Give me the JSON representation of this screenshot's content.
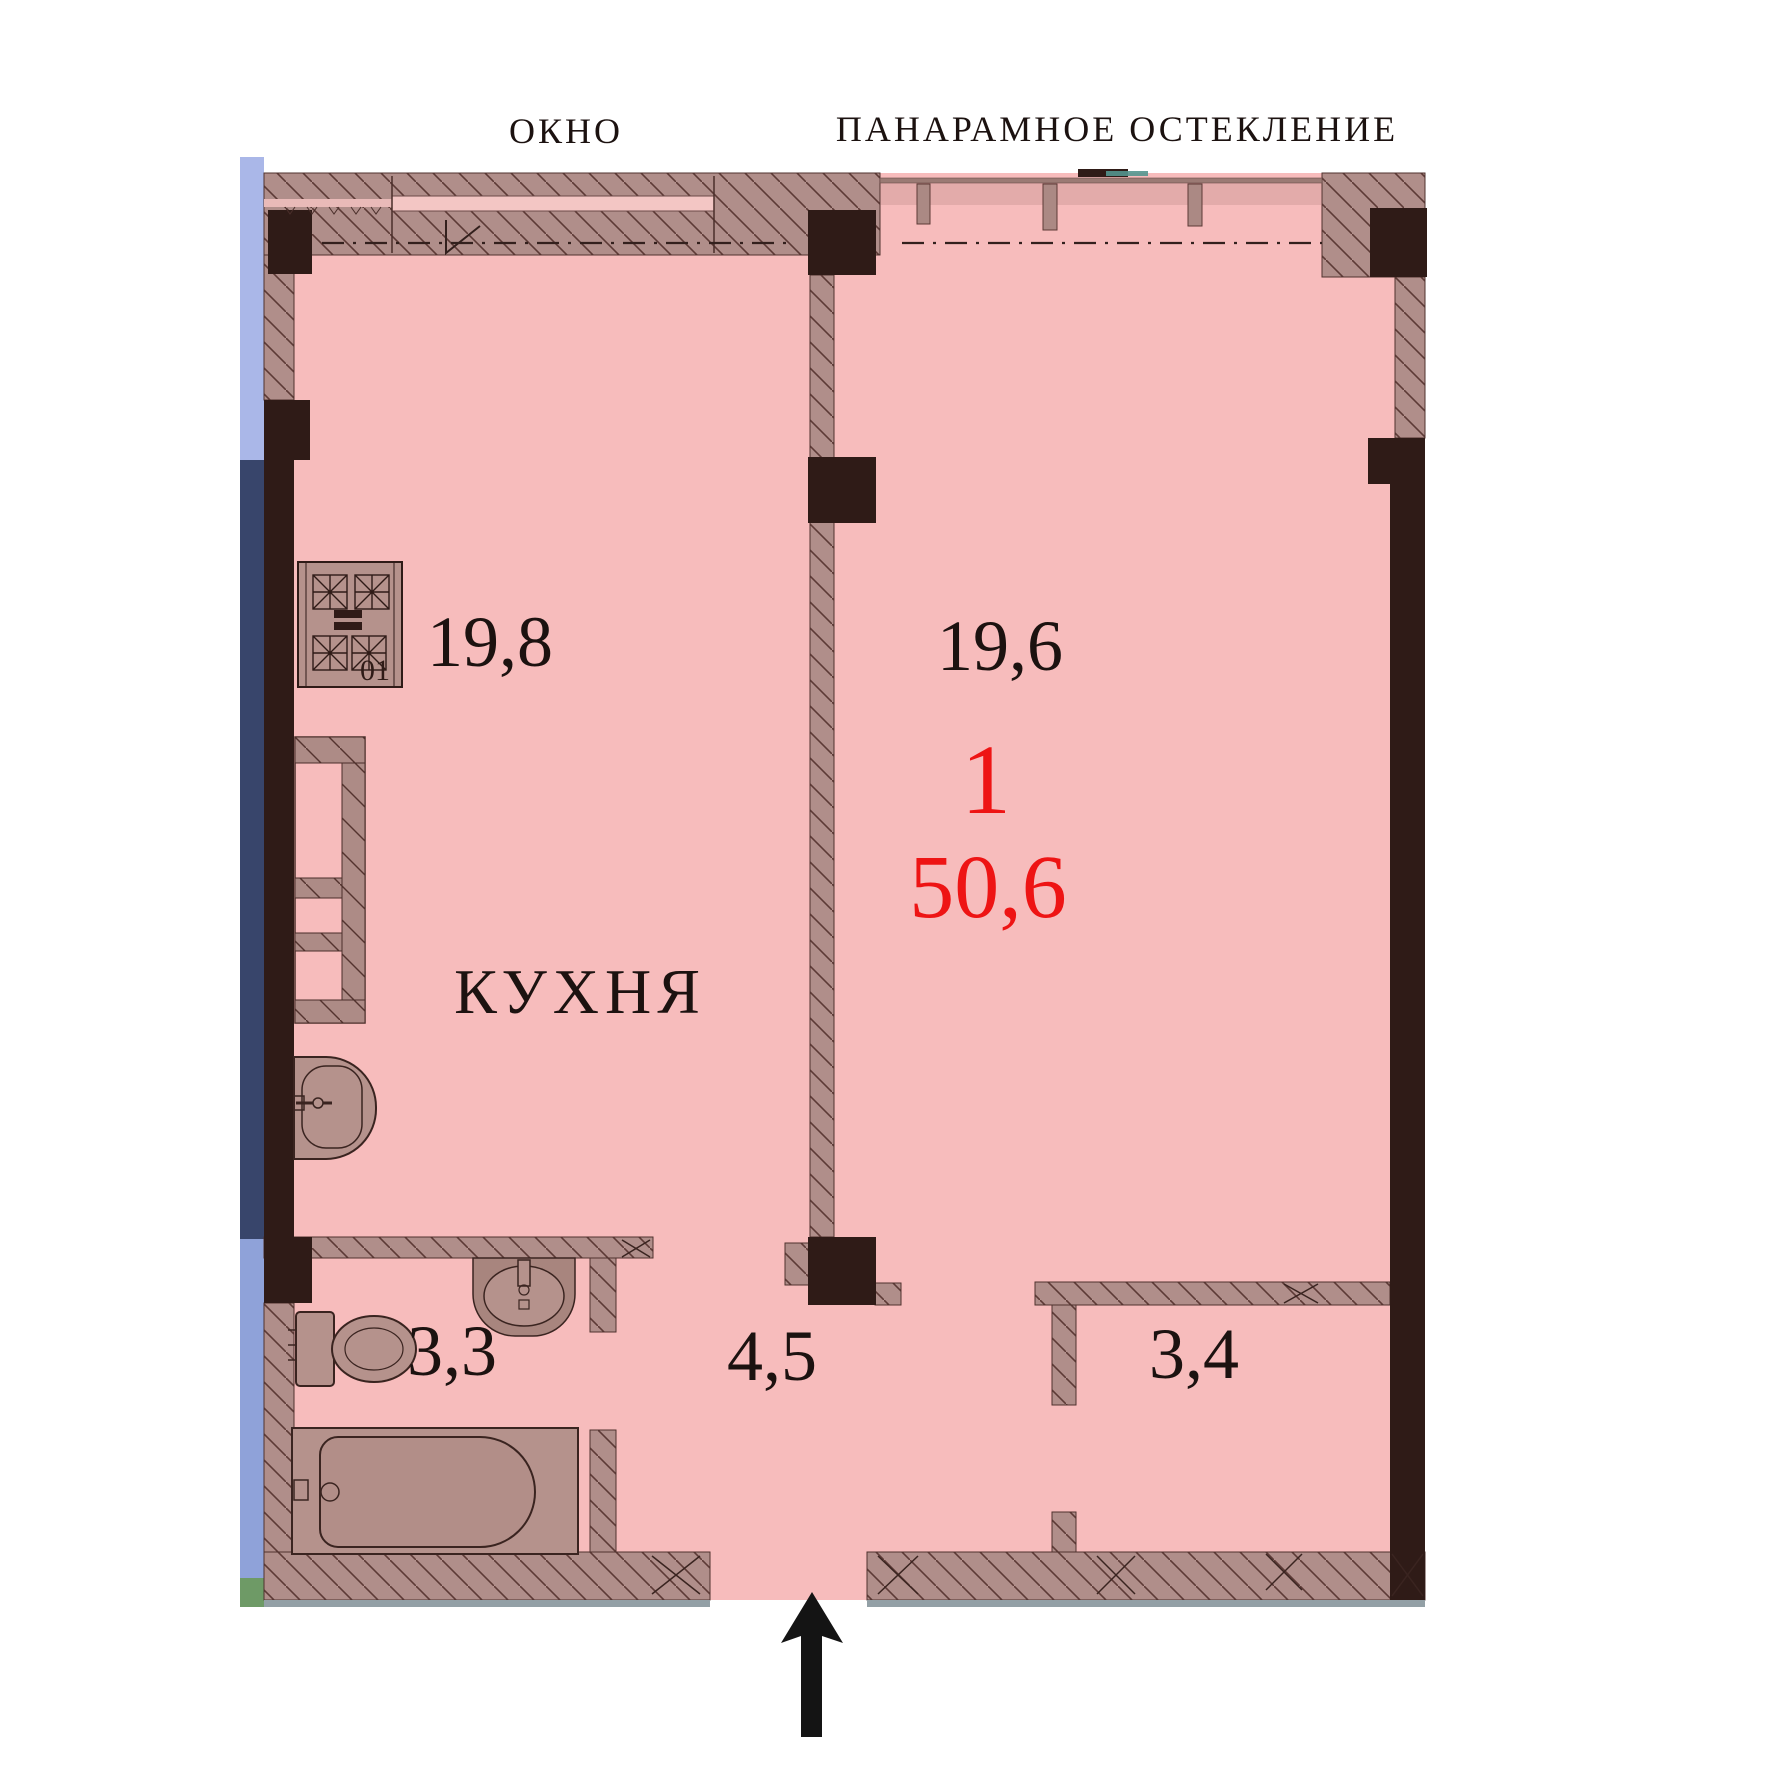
{
  "header": {
    "window": "ОКНО",
    "panoramic_glazing": "ПАНАРАМНОЕ ОСТЕКЛЕНИЕ"
  },
  "apartment": {
    "rooms_count": "1",
    "total_area": "50,6",
    "kitchen_name": "КУХНЯ",
    "kitchen_area": "19,8",
    "living_area": "19,6",
    "bathroom_area": "3,3",
    "hall_area": "4,5",
    "closet_area": "3,4",
    "stove_mark": "01"
  },
  "colors": {
    "floor": "#f7bcbc",
    "wall_hatch": "#b08e8a",
    "wall_dark": "#2f1b17",
    "accent_red": "#ee1414",
    "text": "#1c1210",
    "glazing_blue": "#8fa2d9"
  }
}
